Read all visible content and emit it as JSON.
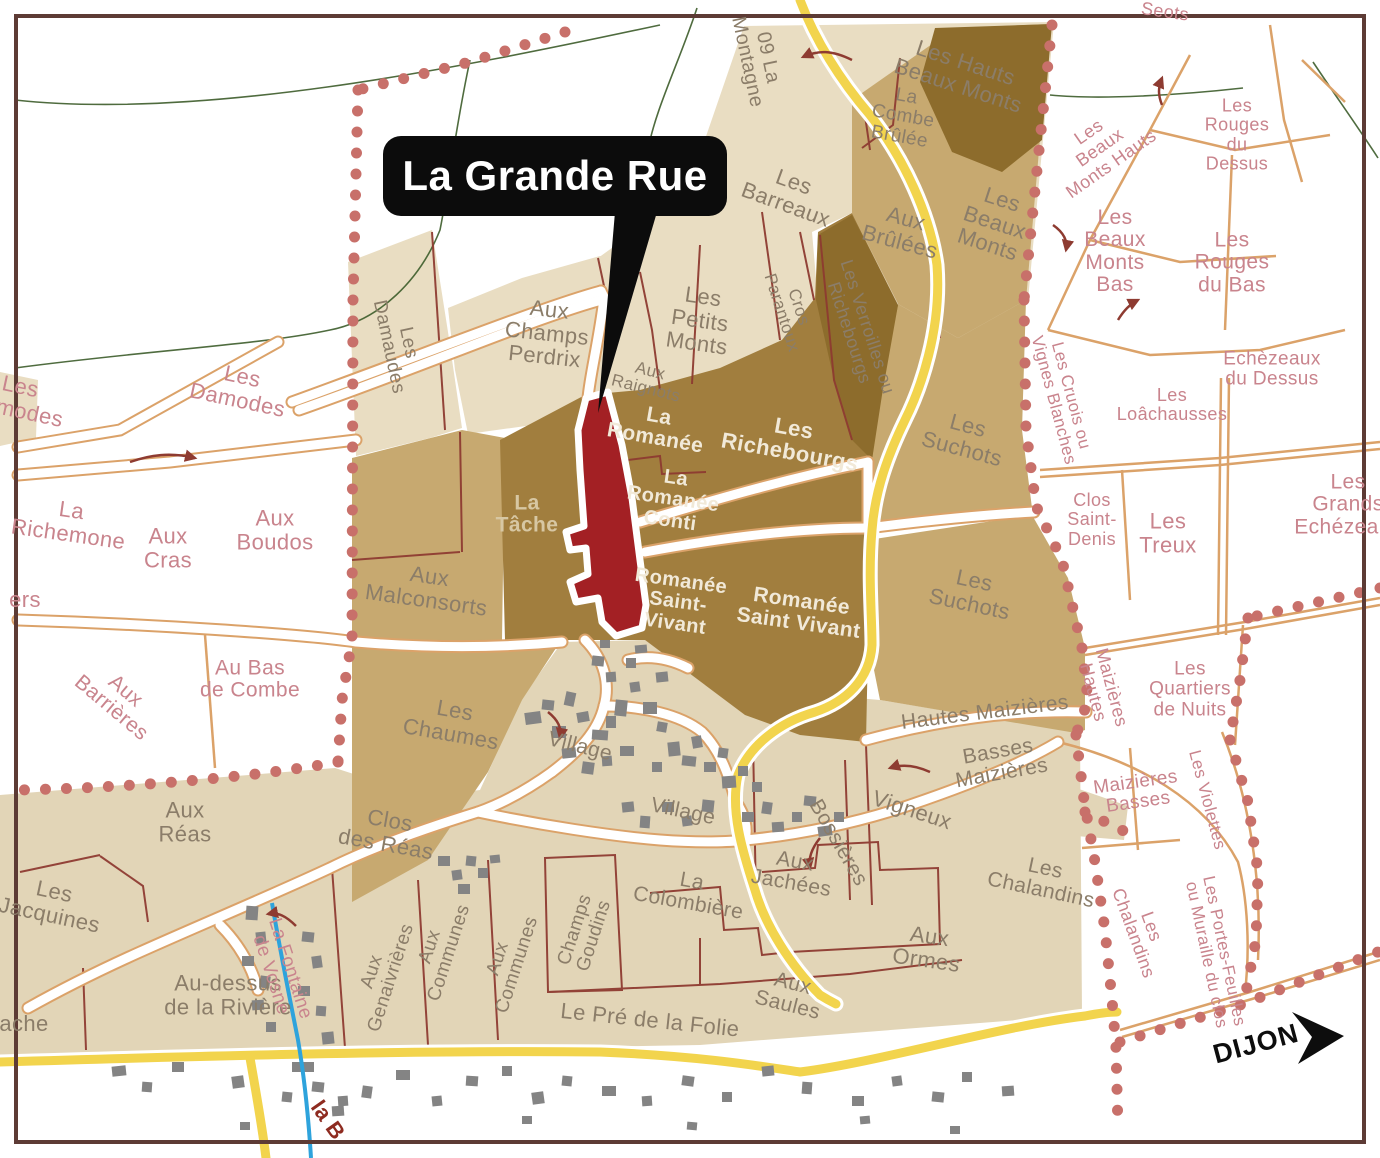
{
  "callout": {
    "label": "La Grande Rue"
  },
  "direction_sign": {
    "label": "DIJON"
  },
  "colors": {
    "highlight_parcel_red": "#a32024",
    "boundary_dots": "#c8706a",
    "road_yellow": "#f2d44d",
    "road_casing_orange": "#dba269",
    "parcel_dark": "#a17e3e",
    "parcel_darker": "#8d6c2c",
    "parcel_mid": "#c7a970",
    "parcel_pale": "#e9ddc2",
    "stream_blue": "#2ea3dc",
    "contour_green": "#3c5c2a",
    "boundary_line_red": "#8e3b31"
  },
  "map": {
    "labels": [
      {
        "name": "road-label-la-montagne",
        "text": "09 La\nMontagne",
        "x": 757,
        "y": 60,
        "rot": 78,
        "size": 20,
        "cls": "gray"
      },
      {
        "name": "label-les-hauts-beaux-monts",
        "text": "Les Hauts\nBeaux Monts",
        "x": 962,
        "y": 74,
        "rot": 18,
        "size": 22,
        "cls": "gray"
      },
      {
        "name": "label-la-combe-brulee",
        "text": "La\nCombe\nBrûlée",
        "x": 903,
        "y": 117,
        "rot": 10,
        "size": 19,
        "cls": "gray"
      },
      {
        "name": "label-les-barreaux",
        "text": "Les\nBarreaux",
        "x": 790,
        "y": 193,
        "rot": 20,
        "size": 22,
        "cls": "gray"
      },
      {
        "name": "label-aux-brulees",
        "text": "Aux\nBrûlées",
        "x": 903,
        "y": 230,
        "rot": 15,
        "size": 22,
        "cls": "gray"
      },
      {
        "name": "label-les-beaux-monts",
        "text": "Les\nBeaux\nMonts",
        "x": 995,
        "y": 222,
        "rot": 18,
        "size": 22,
        "cls": "gray"
      },
      {
        "name": "label-les-beaux-monts-hauts",
        "text": "Les\nBeaux\nMonts Hauts",
        "x": 1100,
        "y": 148,
        "rot": -35,
        "size": 18,
        "cls": "pink"
      },
      {
        "name": "label-les-rouges-du-dessus",
        "text": "Les\nRouges\ndu\nDessus",
        "x": 1237,
        "y": 135,
        "rot": 0,
        "size": 18,
        "cls": "pink"
      },
      {
        "name": "label-les-beaux-monts-bas",
        "text": "Les\nBeaux\nMonts\nBas",
        "x": 1115,
        "y": 252,
        "rot": 0,
        "size": 21,
        "cls": "pink"
      },
      {
        "name": "label-les-rouges-du-bas",
        "text": "Les\nRouges\ndu Bas",
        "x": 1232,
        "y": 263,
        "rot": 0,
        "size": 21,
        "cls": "pink"
      },
      {
        "name": "label-echezeaux-du-dessus",
        "text": "Echèzeaux\ndu Dessus",
        "x": 1272,
        "y": 370,
        "rot": 0,
        "size": 19,
        "cls": "pink"
      },
      {
        "name": "label-les-loachausses",
        "text": "Les\nLoâchausses",
        "x": 1172,
        "y": 405,
        "rot": 0,
        "size": 18,
        "cls": "pink"
      },
      {
        "name": "label-les-cruois-ou-vignes-blanches",
        "text": "Les Cruois ou\nVignes Blanches",
        "x": 1062,
        "y": 398,
        "rot": 75,
        "size": 17,
        "cls": "pink"
      },
      {
        "name": "label-les-grands-echezeaux",
        "text": "Les\nGrands\nEchézeaux",
        "x": 1348,
        "y": 505,
        "rot": 0,
        "size": 21,
        "cls": "pink"
      },
      {
        "name": "label-clos-saint-denis",
        "text": "Clos\nSaint-\nDenis",
        "x": 1092,
        "y": 520,
        "rot": 0,
        "size": 18,
        "cls": "pink"
      },
      {
        "name": "label-les-treux",
        "text": "Les\nTreux",
        "x": 1168,
        "y": 533,
        "rot": 0,
        "size": 22,
        "cls": "pink"
      },
      {
        "name": "label-les-damodes",
        "text": "Les\nDamodes",
        "x": 240,
        "y": 388,
        "rot": 12,
        "size": 22,
        "cls": "pink"
      },
      {
        "name": "label-les-damodes-cut",
        "text": "Les\nDamodes",
        "x": 18,
        "y": 398,
        "rot": 12,
        "size": 22,
        "cls": "pink"
      },
      {
        "name": "label-la-richemone",
        "text": "La\nRichemone",
        "x": 70,
        "y": 522,
        "rot": 8,
        "size": 22,
        "cls": "pink"
      },
      {
        "name": "fragment-label-ers",
        "text": "ers",
        "x": 25,
        "y": 600,
        "rot": 0,
        "size": 22,
        "cls": "pink"
      },
      {
        "name": "label-aux-cras",
        "text": "Aux\nCras",
        "x": 168,
        "y": 548,
        "rot": 0,
        "size": 22,
        "cls": "pink"
      },
      {
        "name": "label-aux-boudos",
        "text": "Aux\nBoudos",
        "x": 275,
        "y": 530,
        "rot": 0,
        "size": 22,
        "cls": "pink"
      },
      {
        "name": "label-aux-barrieres",
        "text": "Aux\nBarrières",
        "x": 118,
        "y": 700,
        "rot": 40,
        "size": 21,
        "cls": "pink"
      },
      {
        "name": "label-au-bas-de-combe",
        "text": "Au Bas\nde Combe",
        "x": 250,
        "y": 680,
        "rot": 0,
        "size": 21,
        "cls": "pink"
      },
      {
        "name": "label-aux-reas",
        "text": "Aux\nRéas",
        "x": 185,
        "y": 822,
        "rot": 0,
        "size": 22,
        "cls": "gray"
      },
      {
        "name": "label-les-jacquines",
        "text": "Les\nJacquines",
        "x": 52,
        "y": 903,
        "rot": 12,
        "size": 22,
        "cls": "gray"
      },
      {
        "name": "label-au-dessus-de-la-riviere",
        "text": "Au-dessus\nde la Rivière",
        "x": 228,
        "y": 995,
        "rot": 0,
        "size": 22,
        "cls": "gray"
      },
      {
        "name": "fragment-label-ache",
        "text": "ache",
        "x": 24,
        "y": 1024,
        "rot": 0,
        "size": 22,
        "cls": "gray"
      },
      {
        "name": "label-la-fontaine-de-vosne",
        "text": "La Fontaine\nde Vosne",
        "x": 280,
        "y": 972,
        "rot": 72,
        "size": 19,
        "cls": "pink"
      },
      {
        "name": "label-aux-genaivrieres",
        "text": "Aux\nGenaivrières",
        "x": 382,
        "y": 975,
        "rot": -72,
        "size": 19,
        "cls": "gray"
      },
      {
        "name": "fragment-label-la-b",
        "text": "la B",
        "x": 328,
        "y": 1120,
        "rot": 55,
        "size": 22,
        "cls": "redtxt"
      },
      {
        "name": "label-aux-champs-perdrix",
        "text": "Aux\nChamps\nPerdrix",
        "x": 547,
        "y": 333,
        "rot": 6,
        "size": 22,
        "cls": "gray"
      },
      {
        "name": "label-les-damaudes",
        "text": "Les\nDamaudes",
        "x": 398,
        "y": 345,
        "rot": 78,
        "size": 19,
        "cls": "gray"
      },
      {
        "name": "label-aux-raignots",
        "text": "Aux\nRaignots",
        "x": 648,
        "y": 380,
        "rot": 14,
        "size": 17,
        "cls": "gray"
      },
      {
        "name": "label-les-petits-monts",
        "text": "Les\nPetits\nMonts",
        "x": 700,
        "y": 320,
        "rot": 8,
        "size": 22,
        "cls": "gray"
      },
      {
        "name": "label-cros-parantoux",
        "text": "Cros\nParantoux",
        "x": 790,
        "y": 310,
        "rot": 72,
        "size": 17,
        "cls": "gray"
      },
      {
        "name": "label-les-verroilles-ou-richebourgs",
        "text": "Les Verroilles ou\nRichebourgs",
        "x": 858,
        "y": 330,
        "rot": 72,
        "size": 18,
        "cls": "gray"
      },
      {
        "name": "label-la-romanee",
        "text": "La\nRomanée",
        "x": 657,
        "y": 428,
        "rot": 10,
        "size": 21,
        "cls": "white"
      },
      {
        "name": "label-les-richebourgs",
        "text": "Les\nRichebourgs",
        "x": 792,
        "y": 440,
        "rot": 10,
        "size": 22,
        "cls": "white"
      },
      {
        "name": "label-la-romanee-conti",
        "text": "La\nRomanée\nConti",
        "x": 673,
        "y": 500,
        "rot": 8,
        "size": 20,
        "cls": "white"
      },
      {
        "name": "label-la-tache",
        "text": "La\nTâche",
        "x": 527,
        "y": 515,
        "rot": 0,
        "size": 21,
        "cls": "tan"
      },
      {
        "name": "label-aux-malconsorts",
        "text": "Aux\nMalconsorts",
        "x": 428,
        "y": 588,
        "rot": 8,
        "size": 22,
        "cls": "gray"
      },
      {
        "name": "label-romanee-saint-vivant-w",
        "text": "Romanée\nSaint-\nVivant",
        "x": 678,
        "y": 603,
        "rot": 8,
        "size": 20,
        "cls": "white"
      },
      {
        "name": "label-romanee-saint-vivant-e",
        "text": "Romanée\nSaint Vivant",
        "x": 800,
        "y": 613,
        "rot": 8,
        "size": 21,
        "cls": "white"
      },
      {
        "name": "label-les-suchots-upper",
        "text": "Les\nSuchots",
        "x": 965,
        "y": 437,
        "rot": 15,
        "size": 22,
        "cls": "gray"
      },
      {
        "name": "label-les-suchots-lower",
        "text": "Les\nSuchots",
        "x": 972,
        "y": 592,
        "rot": 12,
        "size": 22,
        "cls": "gray"
      },
      {
        "name": "label-hautes-maizieres",
        "text": "Hautes Maizières",
        "x": 985,
        "y": 713,
        "rot": -7,
        "size": 21,
        "cls": "gray"
      },
      {
        "name": "label-maizieres-hautes",
        "text": "Maizières\nHautes",
        "x": 1102,
        "y": 690,
        "rot": 75,
        "size": 18,
        "cls": "pink"
      },
      {
        "name": "label-les-quartiers-de-nuits",
        "text": "Les\nQuartiers\nde Nuits",
        "x": 1190,
        "y": 690,
        "rot": 0,
        "size": 19,
        "cls": "pink"
      },
      {
        "name": "label-les-violettes",
        "text": "Les Violettes",
        "x": 1207,
        "y": 800,
        "rot": 75,
        "size": 17,
        "cls": "pink"
      },
      {
        "name": "label-maizieres-basses",
        "text": "Maizières\nBasses",
        "x": 1137,
        "y": 793,
        "rot": -8,
        "size": 19,
        "cls": "pink"
      },
      {
        "name": "label-basses-maizieres",
        "text": "Basses\nMaizières",
        "x": 1000,
        "y": 763,
        "rot": -10,
        "size": 21,
        "cls": "gray"
      },
      {
        "name": "label-vigneux",
        "text": "Vigneux",
        "x": 912,
        "y": 810,
        "rot": 18,
        "size": 22,
        "cls": "gray"
      },
      {
        "name": "label-bossieres",
        "text": "Bossières",
        "x": 838,
        "y": 843,
        "rot": 60,
        "size": 21,
        "cls": "gray"
      },
      {
        "name": "label-aux-jachees",
        "text": "Aux\nJachées",
        "x": 793,
        "y": 873,
        "rot": 10,
        "size": 21,
        "cls": "gray"
      },
      {
        "name": "label-les-chalandins-w",
        "text": "Les\nChalandins",
        "x": 1043,
        "y": 880,
        "rot": 12,
        "size": 21,
        "cls": "gray"
      },
      {
        "name": "label-les-chalandins-e",
        "text": "Les\nChalandins",
        "x": 1142,
        "y": 930,
        "rot": 70,
        "size": 18,
        "cls": "pink"
      },
      {
        "name": "label-les-portes-feuilles",
        "text": "Les Portes-Feuilles\nou Muraille du clos",
        "x": 1215,
        "y": 953,
        "rot": 78,
        "size": 17,
        "cls": "pink"
      },
      {
        "name": "label-village-n",
        "text": "Village",
        "x": 580,
        "y": 747,
        "rot": 14,
        "size": 21,
        "cls": "gray"
      },
      {
        "name": "label-village-s",
        "text": "Village",
        "x": 683,
        "y": 812,
        "rot": 12,
        "size": 21,
        "cls": "gray"
      },
      {
        "name": "label-les-chaumes",
        "text": "Les\nChaumes",
        "x": 453,
        "y": 722,
        "rot": 10,
        "size": 22,
        "cls": "gray"
      },
      {
        "name": "label-clos-des-reas",
        "text": "Clos\ndes Réas",
        "x": 388,
        "y": 832,
        "rot": 10,
        "size": 22,
        "cls": "gray"
      },
      {
        "name": "label-aux-communes-w",
        "text": "Aux\nCommunes",
        "x": 440,
        "y": 950,
        "rot": -72,
        "size": 19,
        "cls": "gray"
      },
      {
        "name": "label-aux-communes-e",
        "text": "Aux\nCommunes",
        "x": 508,
        "y": 962,
        "rot": -72,
        "size": 19,
        "cls": "gray"
      },
      {
        "name": "label-champs-goudins",
        "text": "Champs\nGoudins",
        "x": 585,
        "y": 933,
        "rot": -72,
        "size": 19,
        "cls": "gray"
      },
      {
        "name": "label-la-colombiere",
        "text": "La\nColombière",
        "x": 690,
        "y": 893,
        "rot": 10,
        "size": 21,
        "cls": "gray"
      },
      {
        "name": "label-le-pre-de-la-folie",
        "text": "Le Pré de la Folie",
        "x": 650,
        "y": 1020,
        "rot": 6,
        "size": 22,
        "cls": "gray"
      },
      {
        "name": "label-aux-saules",
        "text": "Aux\nSaules",
        "x": 790,
        "y": 995,
        "rot": 14,
        "size": 21,
        "cls": "gray"
      },
      {
        "name": "label-aux-ormes",
        "text": "Aux\nOrmes",
        "x": 928,
        "y": 948,
        "rot": 8,
        "size": 22,
        "cls": "gray"
      },
      {
        "name": "fragment-label-seots",
        "text": "Seots",
        "x": 1165,
        "y": 12,
        "rot": 8,
        "size": 18,
        "cls": "pink"
      },
      {
        "name": "direction-label-dijon",
        "text": "DIJON",
        "x": 1256,
        "y": 1044,
        "rot": -15,
        "size": 27,
        "cls": "dijon"
      }
    ]
  }
}
